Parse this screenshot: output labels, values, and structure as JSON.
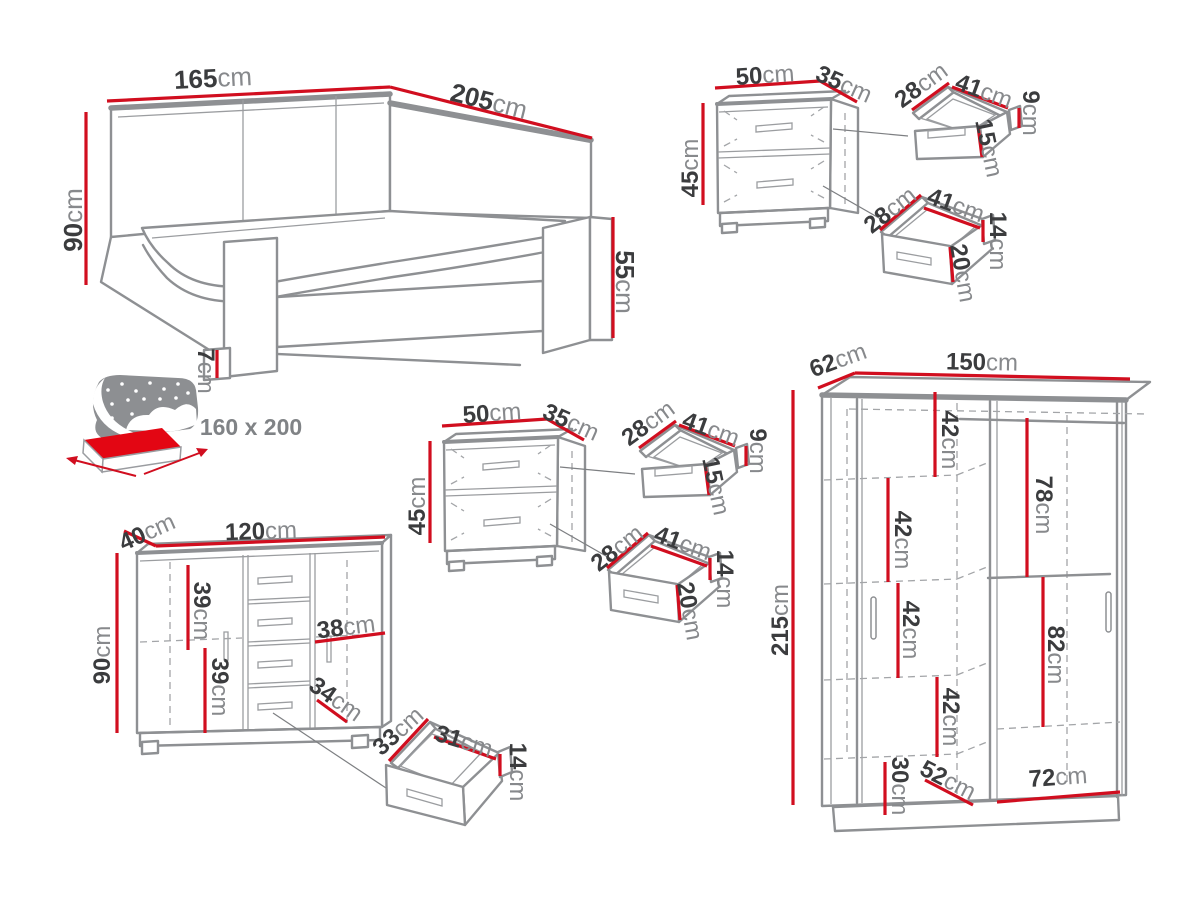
{
  "palette": {
    "dimension_red": "#d10e1f",
    "number_color": "#3b3c3e",
    "unit_color": "#87898c",
    "outline_grey": "#8e9093",
    "icon_grey": "#8d8f92",
    "icon_red": "#e30613"
  },
  "bed": {
    "width": {
      "v": "165",
      "u": "cm"
    },
    "length": {
      "v": "205",
      "u": "cm"
    },
    "headboard_height": {
      "v": "90",
      "u": "cm"
    },
    "footboard_height": {
      "v": "55",
      "u": "cm"
    },
    "leg_height": {
      "v": "7",
      "u": "cm"
    },
    "mattress_size": "160 x 200"
  },
  "nightstand_top": {
    "width": {
      "v": "50",
      "u": "cm"
    },
    "depth": {
      "v": "35",
      "u": "cm"
    },
    "height": {
      "v": "45",
      "u": "cm"
    },
    "drawer_top": {
      "depth": {
        "v": "28",
        "u": "cm"
      },
      "width": {
        "v": "41",
        "u": "cm"
      },
      "back_height": {
        "v": "9",
        "u": "cm"
      },
      "front_height": {
        "v": "15",
        "u": "cm"
      }
    },
    "drawer_bottom": {
      "depth": {
        "v": "28",
        "u": "cm"
      },
      "width": {
        "v": "41",
        "u": "cm"
      },
      "back_height": {
        "v": "14",
        "u": "cm"
      },
      "front_height": {
        "v": "20",
        "u": "cm"
      }
    }
  },
  "nightstand_middle": {
    "width": {
      "v": "50",
      "u": "cm"
    },
    "depth": {
      "v": "35",
      "u": "cm"
    },
    "height": {
      "v": "45",
      "u": "cm"
    },
    "drawer_top": {
      "depth": {
        "v": "28",
        "u": "cm"
      },
      "width": {
        "v": "41",
        "u": "cm"
      },
      "back_height": {
        "v": "9",
        "u": "cm"
      },
      "front_height": {
        "v": "15",
        "u": "cm"
      }
    },
    "drawer_bottom": {
      "depth": {
        "v": "28",
        "u": "cm"
      },
      "width": {
        "v": "41",
        "u": "cm"
      },
      "back_height": {
        "v": "14",
        "u": "cm"
      },
      "front_height": {
        "v": "20",
        "u": "cm"
      }
    }
  },
  "chest": {
    "depth": {
      "v": "40",
      "u": "cm"
    },
    "width": {
      "v": "120",
      "u": "cm"
    },
    "height": {
      "v": "90",
      "u": "cm"
    },
    "upper_shelf_height": {
      "v": "39",
      "u": "cm"
    },
    "lower_shelf_height": {
      "v": "39",
      "u": "cm"
    },
    "door_width": {
      "v": "38",
      "u": "cm"
    },
    "bottom_width": {
      "v": "34",
      "u": "cm"
    },
    "drawer": {
      "depth": {
        "v": "33",
        "u": "cm"
      },
      "width": {
        "v": "31",
        "u": "cm"
      },
      "front_height": {
        "v": "14",
        "u": "cm"
      }
    }
  },
  "wardrobe": {
    "depth": {
      "v": "62",
      "u": "cm"
    },
    "width": {
      "v": "150",
      "u": "cm"
    },
    "height": {
      "v": "215",
      "u": "cm"
    },
    "shelf1": {
      "v": "42",
      "u": "cm"
    },
    "top_hanging": {
      "v": "78",
      "u": "cm"
    },
    "shelf2": {
      "v": "42",
      "u": "cm"
    },
    "shelf3": {
      "v": "42",
      "u": "cm"
    },
    "shelf4": {
      "v": "42",
      "u": "cm"
    },
    "bottom_hanging": {
      "v": "82",
      "u": "cm"
    },
    "bottom_shelf": {
      "v": "30",
      "u": "cm"
    },
    "inner_depth": {
      "v": "52",
      "u": "cm"
    },
    "right_width": {
      "v": "72",
      "u": "cm"
    }
  }
}
